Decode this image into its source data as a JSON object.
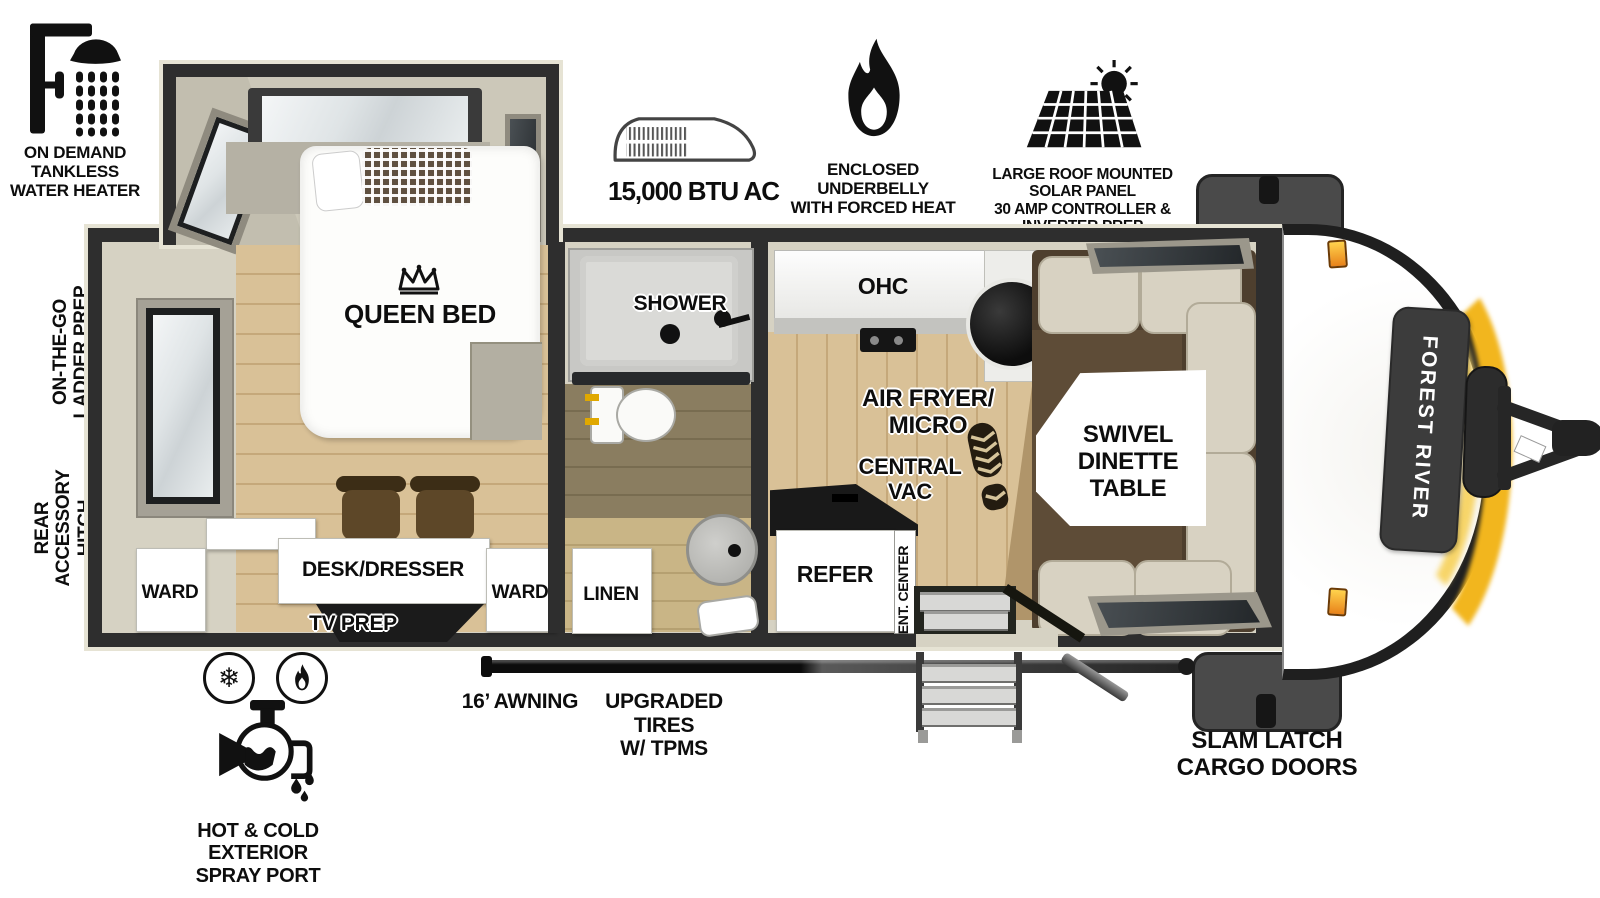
{
  "features": {
    "water_heater": {
      "icon": "shower-head-icon",
      "label": "ON DEMAND\nTANKLESS\nWATER HEATER"
    },
    "ac": {
      "icon": "ac-unit-icon",
      "label": "15,000 BTU AC"
    },
    "underbelly": {
      "icon": "flame-icon",
      "label": "ENCLOSED UNDERBELLY\nWITH FORCED HEAT"
    },
    "solar": {
      "icon": "solar-panel-icon",
      "label": "LARGE ROOF MOUNTED SOLAR PANEL\n30 AMP CONTROLLER & INVERTER PREP"
    },
    "spray_port": {
      "icon": "spray-port-icon",
      "label": "HOT & COLD EXTERIOR\nSPRAY PORT"
    }
  },
  "side_labels": {
    "ladder": "ON-THE-GO\nLADDER PREP",
    "hitch": "REAR\nACCESSORY\nHITCH"
  },
  "floorplan": {
    "bedroom": {
      "bed": "QUEEN BED",
      "bed_icon": "crown-icon",
      "ward_left": "WARD",
      "ward_right": "WARD",
      "desk": "DESK/DRESSER",
      "tv": "TV PREP"
    },
    "bathroom": {
      "shower": "SHOWER",
      "linen": "LINEN"
    },
    "kitchen": {
      "ohc": "OHC",
      "air_fryer": "AIR FRYER/\nMICRO",
      "central_vac": "CENTRAL\nVAC",
      "central_vac_icon": "boot-print-icon",
      "refer": "REFER",
      "ent_center": "ENT. CENTER",
      "dinette": "SWIVEL\nDINETTE\nTABLE"
    }
  },
  "exterior": {
    "awning": "16’ AWNING",
    "tires": "UPGRADED TIRES\nW/ TPMS",
    "cargo": "SLAM LATCH\nCARGO DOORS",
    "brand": "FOREST RIVER"
  },
  "colors": {
    "wall_black": "#2e2e2e",
    "liner_beige": "#d6d2c3",
    "wood_light": "#d9c197",
    "wood_dark": "#8a7d60",
    "sofa_brown": "#4e3f2e",
    "cushion_tan": "#d8d2c2",
    "glow_yellow": "#f2b61e",
    "marker_orange": "#e8821a"
  }
}
